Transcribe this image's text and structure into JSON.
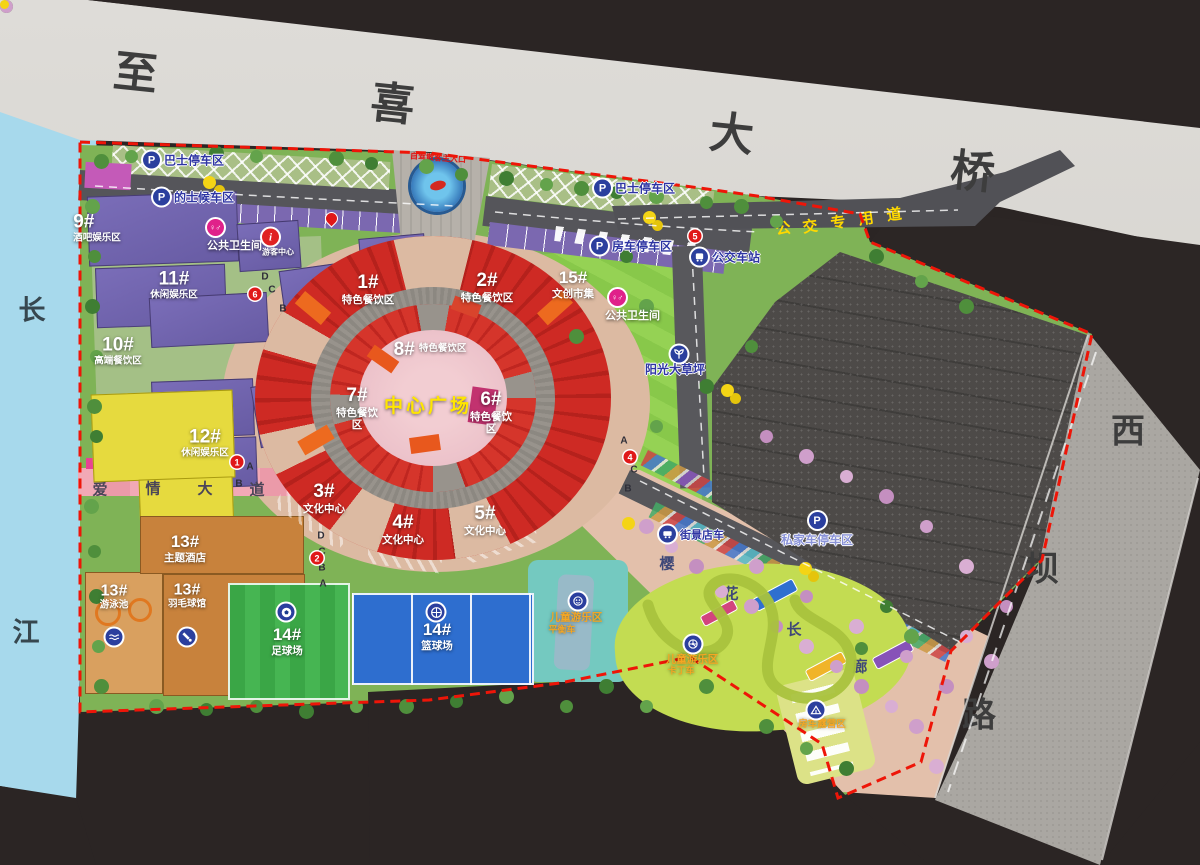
{
  "roads": {
    "bridge_chars": [
      "至",
      "喜",
      "大",
      "桥"
    ],
    "river_chars": [
      "长",
      "江"
    ],
    "west_road_chars": [
      "西",
      "坝",
      "路"
    ],
    "bus_lane_chars": [
      "公",
      "交",
      "专",
      "用",
      "道"
    ],
    "love_avenue_chars": [
      "爱",
      "情",
      "大",
      "道"
    ],
    "cherry_corridor_chars": [
      "樱",
      "花",
      "长",
      "廊"
    ]
  },
  "entrance": {
    "main_gate_note": "自驾散客主入口"
  },
  "plaza": {
    "label": "中心广场"
  },
  "zones": {
    "z1": {
      "num": "1#",
      "name": "特色餐饮区"
    },
    "z2": {
      "num": "2#",
      "name": "特色餐饮区"
    },
    "z3": {
      "num": "3#",
      "name": "文化中心"
    },
    "z4": {
      "num": "4#",
      "name": "文化中心"
    },
    "z5": {
      "num": "5#",
      "name": "文化中心"
    },
    "z6": {
      "num": "6#",
      "name": "特色餐饮区"
    },
    "z7": {
      "num": "7#",
      "name": "特色餐饮区"
    },
    "z8": {
      "num": "8#",
      "name": "特色餐饮区"
    },
    "z9": {
      "num": "9#",
      "name": "酒吧娱乐区"
    },
    "z10": {
      "num": "10#",
      "name": "高端餐饮区"
    },
    "z11": {
      "num": "11#",
      "name": "休闲娱乐区"
    },
    "z12": {
      "num": "12#",
      "name": "休闲娱乐区"
    },
    "z13_hotel": {
      "num": "13#",
      "name": "主题酒店"
    },
    "z13_pool": {
      "num": "13#",
      "name": "游泳池"
    },
    "z13_badminton": {
      "num": "13#",
      "name": "羽毛球馆"
    },
    "z14_soccer": {
      "num": "14#",
      "name": "足球场"
    },
    "z14_basketball": {
      "num": "14#",
      "name": "篮球场"
    },
    "z15": {
      "num": "15#",
      "name": "文创市集"
    },
    "lawn": {
      "name": "阳光大草坪"
    },
    "kids_balance": {
      "name": "儿童游乐区",
      "sub": "平衡车"
    },
    "kids_kart": {
      "name": "儿童游乐区",
      "sub": "卡丁车"
    },
    "rv_camp": {
      "name": "房车露营区"
    }
  },
  "facilities": {
    "bus_parking_left": {
      "label": "巴士停车区",
      "glyph": "P"
    },
    "taxi_waiting": {
      "label": "的士候车区",
      "glyph": "P"
    },
    "bus_parking_right": {
      "label": "巴士停车区",
      "glyph": "P"
    },
    "rv_parking": {
      "label": "房车停车区",
      "glyph": "P"
    },
    "bus_station": {
      "label": "公交车站"
    },
    "private_parking": {
      "label": "私家车停车区",
      "glyph": "P"
    },
    "toilet_left": {
      "label": "公共卫生间",
      "glyph": "♀♂"
    },
    "toilet_right": {
      "label": "公共卫生间",
      "glyph": "♀♂"
    },
    "visitor_center": {
      "label": "游客中心",
      "glyph": "i"
    },
    "street_cart": {
      "label": "街景店车"
    }
  },
  "markers": {
    "gate_numbers": [
      "1",
      "2",
      "4",
      "5",
      "6"
    ],
    "gate_letters": [
      "A",
      "B",
      "C",
      "D"
    ]
  }
}
